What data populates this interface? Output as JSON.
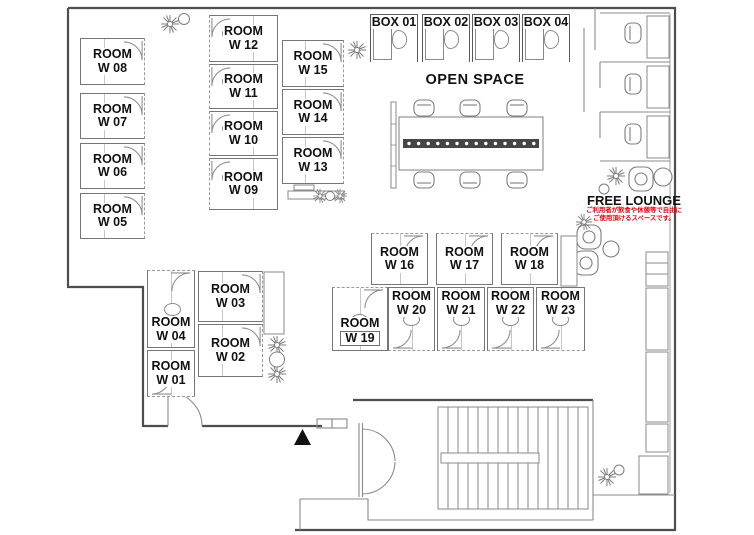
{
  "plan_title": "office-floor-plan",
  "labels": {
    "open_space": "OPEN SPACE",
    "free_lounge": "FREE LOUNGE",
    "free_lounge_note_line1": "ご利用者が飲食や休憩等で自由に",
    "free_lounge_note_line2": "ご使用頂けるスペースです。"
  },
  "colors": {
    "wall": "#7d7d7d",
    "outer_wall": "#4e4e4e",
    "label_text": "#111111",
    "note_red": "#e60012",
    "power_strip": "#454545"
  },
  "rooms": [
    {
      "id": "W01",
      "line1": "ROOM",
      "line2": "W 01",
      "x": 147,
      "y": 350,
      "w": 48,
      "h": 47,
      "door": "bottom",
      "lp": "center"
    },
    {
      "id": "W02",
      "line1": "ROOM",
      "line2": "W 02",
      "x": 198,
      "y": 324,
      "w": 65,
      "h": 53,
      "door": "right",
      "lp": "center"
    },
    {
      "id": "W03",
      "line1": "ROOM",
      "line2": "W 03",
      "x": 198,
      "y": 271,
      "w": 65,
      "h": 51,
      "door": "right",
      "lp": "center"
    },
    {
      "id": "W04",
      "line1": "ROOM",
      "line2": "W 04",
      "x": 147,
      "y": 270,
      "w": 48,
      "h": 78,
      "door": "top",
      "lp": "bottom"
    },
    {
      "id": "W05",
      "line1": "ROOM",
      "line2": "W 05",
      "x": 80,
      "y": 193,
      "w": 65,
      "h": 46,
      "door": "right",
      "lp": "center"
    },
    {
      "id": "W06",
      "line1": "ROOM",
      "line2": "W 06",
      "x": 80,
      "y": 143,
      "w": 65,
      "h": 46,
      "door": "right",
      "lp": "center"
    },
    {
      "id": "W07",
      "line1": "ROOM",
      "line2": "W 07",
      "x": 80,
      "y": 93,
      "w": 65,
      "h": 46,
      "door": "right",
      "lp": "center"
    },
    {
      "id": "W08",
      "line1": "ROOM",
      "line2": "W 08",
      "x": 80,
      "y": 38,
      "w": 65,
      "h": 47,
      "door": "right",
      "lp": "center"
    },
    {
      "id": "W09",
      "line1": "ROOM",
      "line2": "W 09",
      "x": 209,
      "y": 158,
      "w": 69,
      "h": 52,
      "door": "left",
      "lp": "center"
    },
    {
      "id": "W10",
      "line1": "ROOM",
      "line2": "W 10",
      "x": 209,
      "y": 111,
      "w": 69,
      "h": 45,
      "door": "left",
      "lp": "center"
    },
    {
      "id": "W11",
      "line1": "ROOM",
      "line2": "W 11",
      "x": 209,
      "y": 64,
      "w": 69,
      "h": 45,
      "door": "left",
      "lp": "center"
    },
    {
      "id": "W12",
      "line1": "ROOM",
      "line2": "W 12",
      "x": 209,
      "y": 15,
      "w": 69,
      "h": 47,
      "door": "left",
      "lp": "center"
    },
    {
      "id": "W13",
      "line1": "ROOM",
      "line2": "W 13",
      "x": 282,
      "y": 137,
      "w": 62,
      "h": 47,
      "door": "right",
      "lp": "center"
    },
    {
      "id": "W14",
      "line1": "ROOM",
      "line2": "W 14",
      "x": 282,
      "y": 89,
      "w": 62,
      "h": 46,
      "door": "right",
      "lp": "center"
    },
    {
      "id": "W15",
      "line1": "ROOM",
      "line2": "W 15",
      "x": 282,
      "y": 40,
      "w": 62,
      "h": 47,
      "door": "right",
      "lp": "center"
    },
    {
      "id": "W16",
      "line1": "ROOM",
      "line2": "W 16",
      "x": 371,
      "y": 233,
      "w": 57,
      "h": 52,
      "door": "top",
      "lp": "center"
    },
    {
      "id": "W17",
      "line1": "ROOM",
      "line2": "W 17",
      "x": 436,
      "y": 233,
      "w": 57,
      "h": 52,
      "door": "top",
      "lp": "center"
    },
    {
      "id": "W18",
      "line1": "ROOM",
      "line2": "W 18",
      "x": 501,
      "y": 233,
      "w": 57,
      "h": 52,
      "door": "top",
      "lp": "center"
    },
    {
      "id": "W19",
      "line1": "ROOM",
      "line2": "W 19",
      "x": 332,
      "y": 287,
      "w": 56,
      "h": 64,
      "door": "top",
      "lp": "bottom",
      "plate": true
    },
    {
      "id": "W20",
      "line1": "ROOM",
      "line2": "W 20",
      "x": 388,
      "y": 287,
      "w": 47,
      "h": 64,
      "door": "bottom",
      "lp": "top"
    },
    {
      "id": "W21",
      "line1": "ROOM",
      "line2": "W 21",
      "x": 437,
      "y": 287,
      "w": 48,
      "h": 64,
      "door": "bottom",
      "lp": "top"
    },
    {
      "id": "W22",
      "line1": "ROOM",
      "line2": "W 22",
      "x": 487,
      "y": 287,
      "w": 47,
      "h": 64,
      "door": "bottom",
      "lp": "top"
    },
    {
      "id": "W23",
      "line1": "ROOM",
      "line2": "W 23",
      "x": 536,
      "y": 287,
      "w": 49,
      "h": 64,
      "door": "bottom",
      "lp": "top"
    }
  ],
  "boxes": [
    {
      "id": "BOX01",
      "label": "BOX 01",
      "x": 370,
      "y": 14,
      "w": 48,
      "h": 48
    },
    {
      "id": "BOX02",
      "label": "BOX 02",
      "x": 422,
      "y": 14,
      "w": 48,
      "h": 48
    },
    {
      "id": "BOX03",
      "label": "BOX 03",
      "x": 472,
      "y": 14,
      "w": 48,
      "h": 48
    },
    {
      "id": "BOX04",
      "label": "BOX 04",
      "x": 522,
      "y": 14,
      "w": 48,
      "h": 48
    }
  ],
  "icons": [
    "plant-icon",
    "chair-icon",
    "armchair-icon",
    "round-table-icon",
    "door-arc-icon",
    "conference-table",
    "power-strip",
    "whiteboard",
    "staircase",
    "entrance-triangle-icon",
    "cabinet",
    "counter"
  ]
}
